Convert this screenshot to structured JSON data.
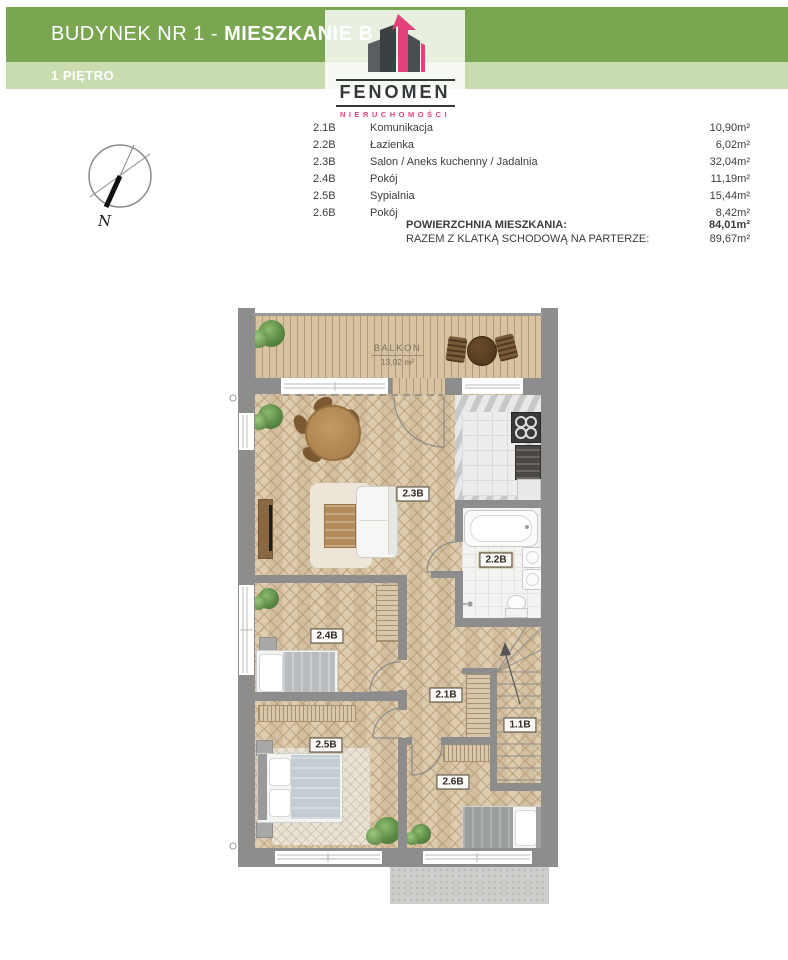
{
  "header": {
    "title_regular": "BUDYNEK NR 1 - ",
    "title_bold": "MIESZKANIE B",
    "subtitle": "1 PIĘTRO"
  },
  "logo": {
    "name": "FENOMEN",
    "tagline": "NIERUCHOMOŚCI",
    "icon": "buildings-with-pink-arrow"
  },
  "compass": {
    "north_label": "N"
  },
  "room_table": {
    "rows": [
      {
        "code": "2.1B",
        "name": "Komunikacja",
        "area": "10,90m²"
      },
      {
        "code": "2.2B",
        "name": "Łazienka",
        "area": "6,02m²"
      },
      {
        "code": "2.3B",
        "name": "Salon / Aneks kuchenny / Jadalnia",
        "area": "32,04m²"
      },
      {
        "code": "2.4B",
        "name": "Pokój",
        "area": "11,19m²"
      },
      {
        "code": "2.5B",
        "name": "Sypialnia",
        "area": "15,44m²"
      },
      {
        "code": "2.6B",
        "name": "Pokój",
        "area": "8,42m²"
      }
    ],
    "total_label": "POWIERZCHNIA MIESZKANIA:",
    "total_value": "84,01m²",
    "total2_label": "RAZEM Z KLATKĄ SCHODOWĄ NA PARTERZE:",
    "total2_value": "89,67m²"
  },
  "floor_plan": {
    "balcony_label": "BALKON",
    "balcony_area": "13,02 m²",
    "labels": {
      "hall": "2.1B",
      "bathroom": "2.2B",
      "salon": "2.3B",
      "room4": "2.4B",
      "bedroom": "2.5B",
      "room6": "2.6B",
      "stairs": "1.1B"
    }
  },
  "colors": {
    "header_green": "#7ba651",
    "header_light_green": "#c8dcb0",
    "logo_pink": "#e2417c",
    "logo_dark": "#34383b",
    "wall_gray": "#8d8d8d",
    "floor_beige": "#dbc8a8",
    "text_gray": "#3c3c3c"
  }
}
